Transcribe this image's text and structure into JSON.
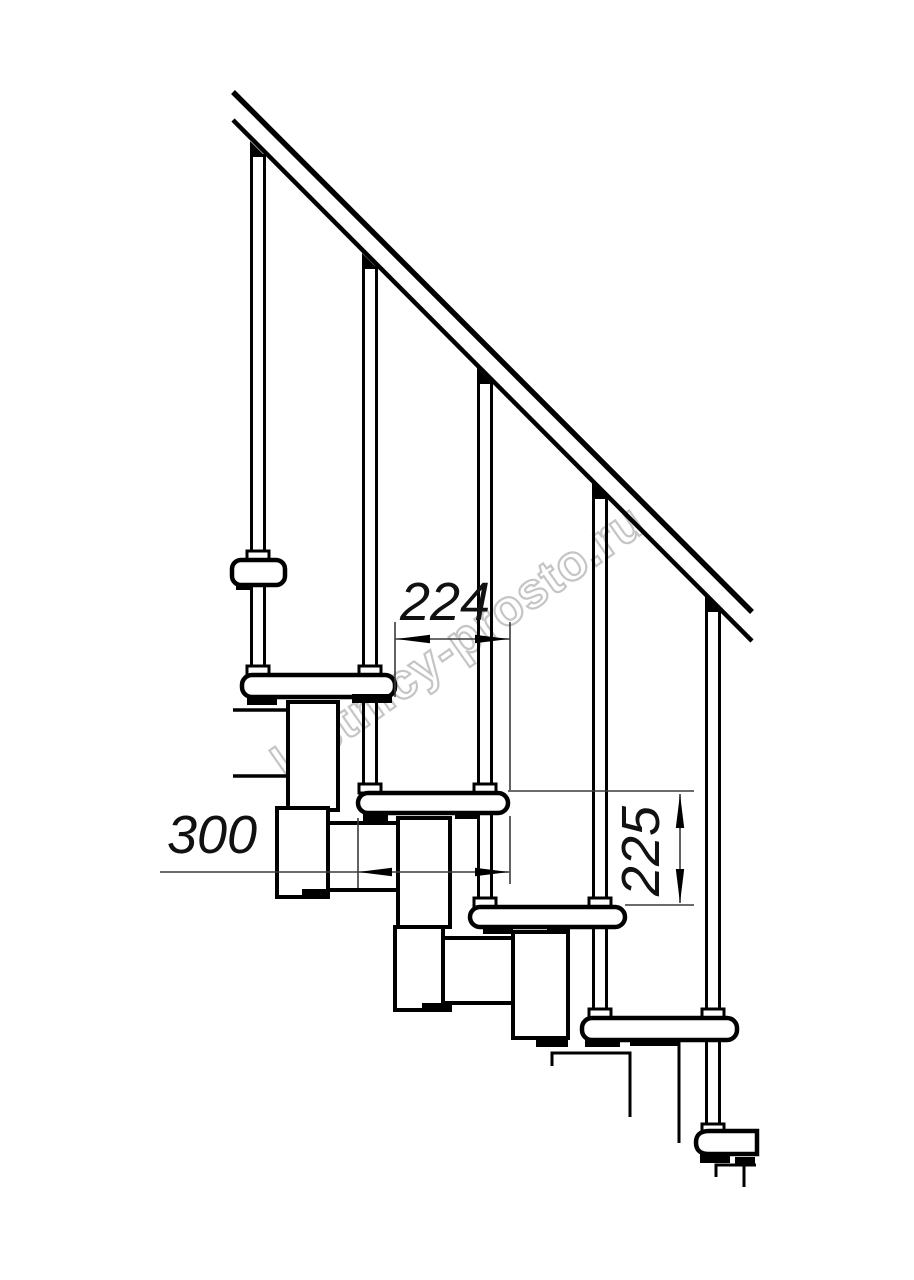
{
  "colors": {
    "line": "#000000",
    "thin_line": "#3a3a3a",
    "watermark_stroke": "#c5c5c5",
    "background": "#ffffff"
  },
  "drawing": {
    "description": "Side-view technical drawing of a modular staircase with handrail, balusters, treads and support modules",
    "watermark": "lestnicy-prosto.ru",
    "dimensions": {
      "step_spacing": "224",
      "tread_depth": "300",
      "riser_height": "225"
    }
  }
}
